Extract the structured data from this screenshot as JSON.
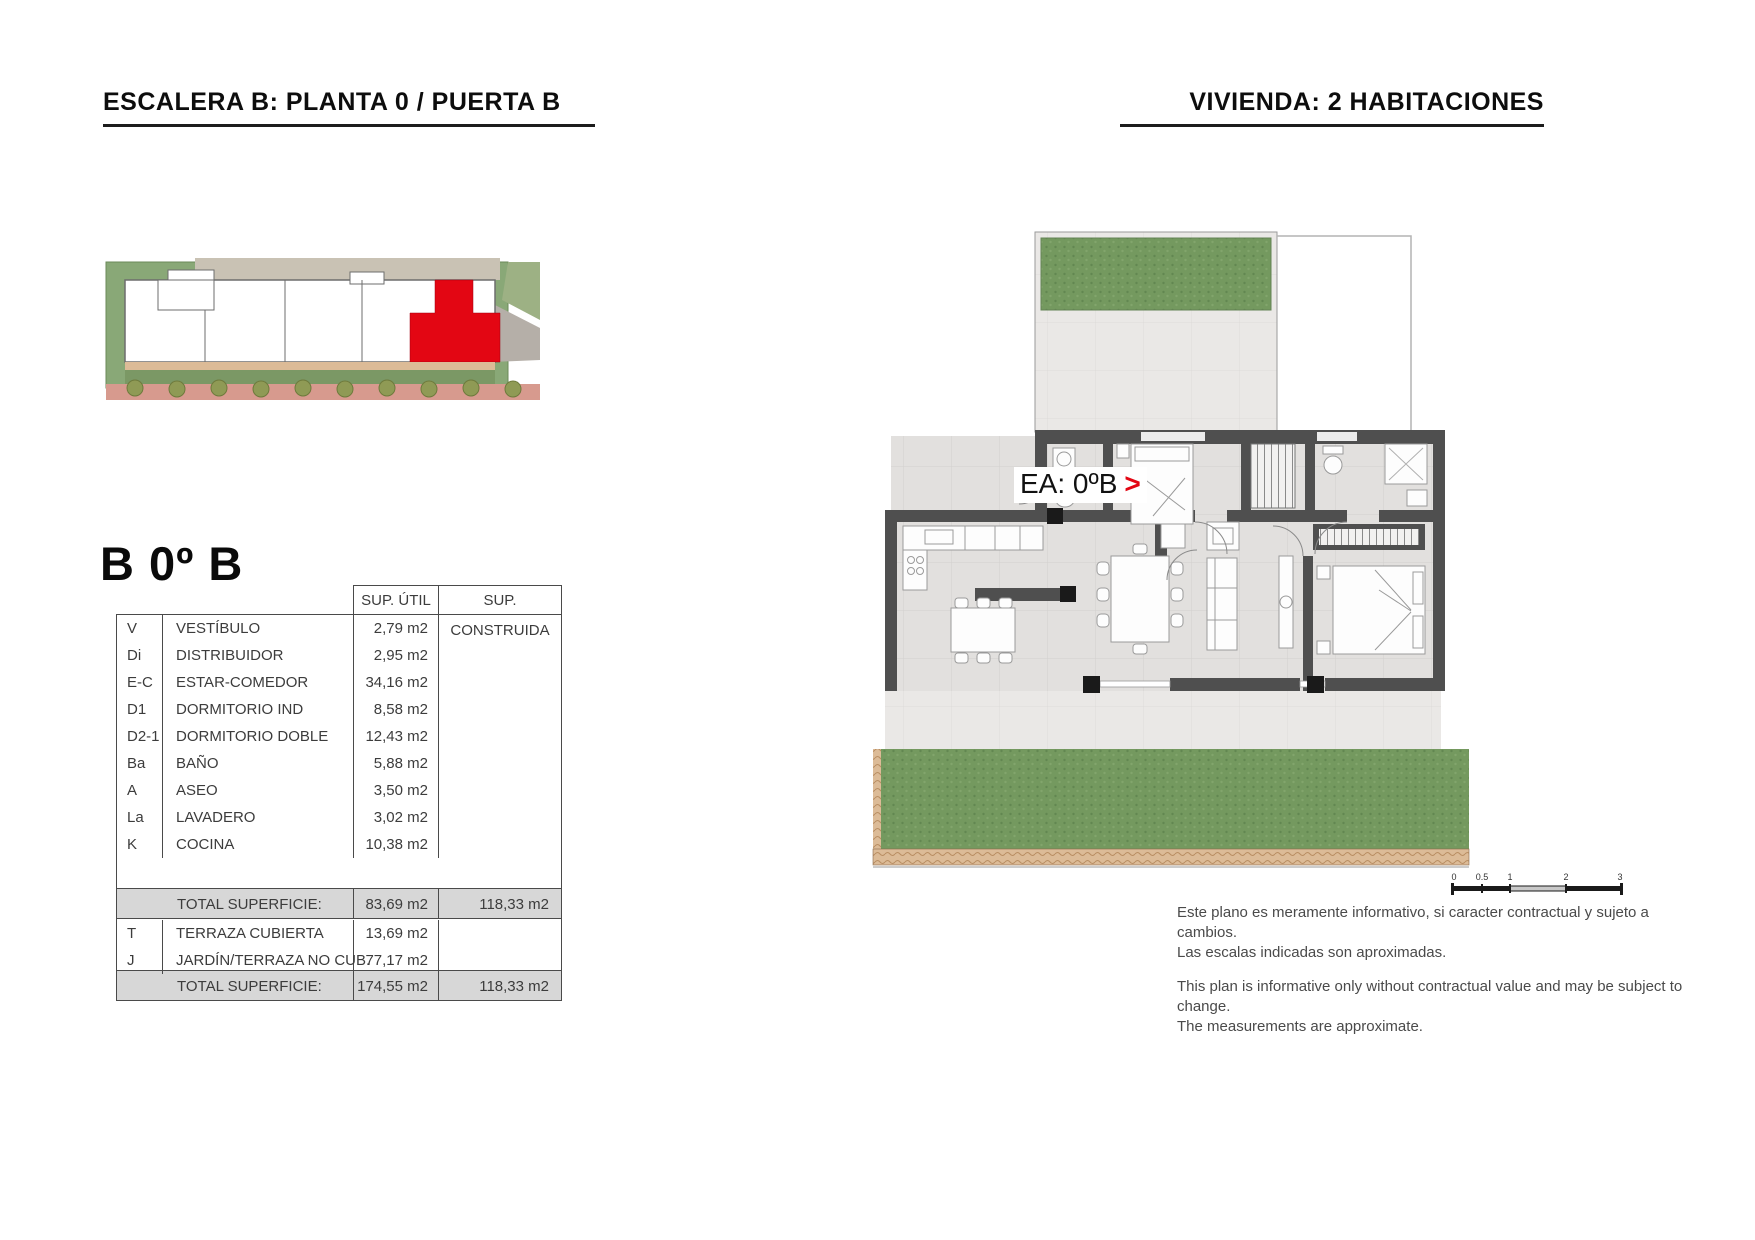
{
  "page": {
    "header_left": "ESCALERA B: PLANTA 0 / PUERTA B",
    "header_right": "VIVIENDA: 2 HABITACIONES"
  },
  "unit": {
    "title": "B 0º B"
  },
  "table": {
    "col_util": "SUP. ÚTIL",
    "col_constr": "SUP. CONSTRUIDA",
    "rooms": [
      {
        "code": "V",
        "name": "VESTÍBULO",
        "util": "2,79 m2",
        "constr": ""
      },
      {
        "code": "Di",
        "name": "DISTRIBUIDOR",
        "util": "2,95 m2",
        "constr": ""
      },
      {
        "code": "E-C",
        "name": "ESTAR-COMEDOR",
        "util": "34,16 m2",
        "constr": ""
      },
      {
        "code": "D1",
        "name": "DORMITORIO IND",
        "util": "8,58 m2",
        "constr": ""
      },
      {
        "code": "D2-1",
        "name": "DORMITORIO DOBLE",
        "util": "12,43 m2",
        "constr": ""
      },
      {
        "code": "Ba",
        "name": "BAÑO",
        "util": "5,88 m2",
        "constr": ""
      },
      {
        "code": "A",
        "name": "ASEO",
        "util": "3,50 m2",
        "constr": ""
      },
      {
        "code": "La",
        "name": "LAVADERO",
        "util": "3,02 m2",
        "constr": ""
      },
      {
        "code": "K",
        "name": "COCINA",
        "util": "10,38 m2",
        "constr": ""
      }
    ],
    "total1": {
      "label": "TOTAL SUPERFICIE:",
      "util": "83,69 m2",
      "constr": "118,33 m2"
    },
    "extras": [
      {
        "code": "T",
        "name": "TERRAZA CUBIERTA",
        "util": "13,69 m2",
        "constr": ""
      },
      {
        "code": "J",
        "name": "JARDÍN/TERRAZA NO CUB.",
        "util": "77,17 m2",
        "constr": ""
      }
    ],
    "total2": {
      "label": "TOTAL SUPERFICIE:",
      "util": "174,55 m2",
      "constr": "118,33 m2"
    }
  },
  "plan": {
    "label": "EA: 0ºB",
    "arrow": ">"
  },
  "scalebar": {
    "ticks": [
      "0",
      "0.5",
      "1",
      "2",
      "3"
    ]
  },
  "disclaimer": {
    "es1": "Este plano es meramente informativo, si caracter contractual y sujeto a cambios.",
    "es2": "Las escalas indicadas son aproximadas.",
    "en1": "This plan is informative only without contractual value and may be subject to change.",
    "en2": "The measurements are approximate."
  },
  "colors": {
    "accent_red": "#e30613",
    "wall_gray": "#4f4f4f",
    "pillar_black": "#1a1a1a",
    "grass_green": "#74995f",
    "terrace_tan": "#dcbb97",
    "sidewalk_pink": "#d79a8e",
    "tree_olive": "#8f9a55",
    "table_gray_bg": "#d7d7d7",
    "border_dark": "#4a4a4a"
  }
}
